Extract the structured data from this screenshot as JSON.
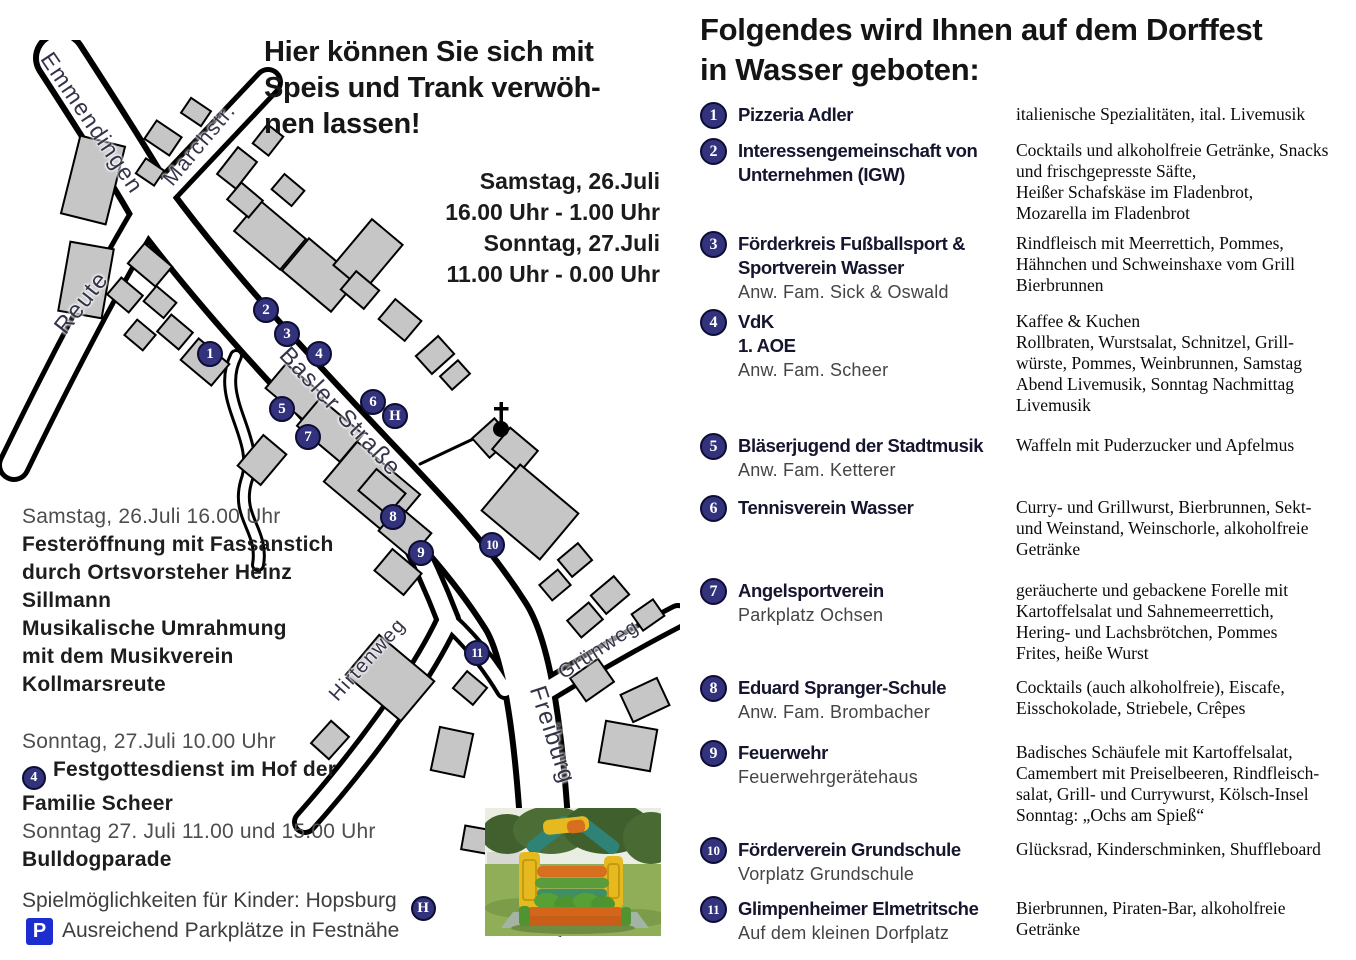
{
  "left": {
    "headline": "Hier können Sie sich mit\nSpeis und Trank verwöh-\nnen lassen!",
    "schedule": "Samstag, 26.Juli\n16.00 Uhr - 1.00 Uhr\nSonntag, 27.Juli\n11.00 Uhr - 0.00 Uhr",
    "saturday": {
      "time": "Samstag, 26.Juli 16.00 Uhr",
      "event1": "Festeröffnung mit Fassanstich\ndurch Ortsvorsteher Heinz\nSillmann",
      "event2": "Musikalische Umrahmung\nmit dem Musikverein\nKollmarsreute"
    },
    "sunday": {
      "time": "Sonntag, 27.Juli 10.00 Uhr",
      "badge": "4",
      "event1": "Festgottesdienst im Hof der",
      "event1b": "Familie Scheer",
      "time2": "Sonntag 27. Juli 11.00 und 15.00 Uhr",
      "event2": "Bulldogparade"
    },
    "kids_line": "Spielmöglichkeiten für Kinder: Hopsburg",
    "kids_badge": "H",
    "parking_icon": "P",
    "parking_line": "Ausreichend Parkplätze in Festnähe"
  },
  "map": {
    "streets": [
      {
        "label": "Emmendingen",
        "x": 92,
        "y": 83,
        "rot": 56,
        "size": 23
      },
      {
        "label": "Marchstr.",
        "x": 200,
        "y": 105,
        "rot": -50,
        "size": 21
      },
      {
        "label": "Reute",
        "x": 82,
        "y": 263,
        "rot": -52,
        "size": 24
      },
      {
        "label": "Basler Straße",
        "x": 340,
        "y": 372,
        "rot": 47,
        "size": 24
      },
      {
        "label": "Hirtenweg",
        "x": 368,
        "y": 620,
        "rot": -48,
        "size": 20
      },
      {
        "label": "Grünweg",
        "x": 599,
        "y": 610,
        "rot": -33,
        "size": 20
      },
      {
        "label": "Freiburg",
        "x": 552,
        "y": 695,
        "rot": 72,
        "size": 24
      }
    ],
    "markers": [
      {
        "label": "1",
        "x": 210,
        "y": 314
      },
      {
        "label": "2",
        "x": 266,
        "y": 270
      },
      {
        "label": "3",
        "x": 287,
        "y": 294
      },
      {
        "label": "4",
        "x": 319,
        "y": 314
      },
      {
        "label": "5",
        "x": 282,
        "y": 369
      },
      {
        "label": "6",
        "x": 373,
        "y": 362
      },
      {
        "label": "H",
        "x": 395,
        "y": 376
      },
      {
        "label": "7",
        "x": 308,
        "y": 397
      },
      {
        "label": "8",
        "x": 393,
        "y": 477
      },
      {
        "label": "9",
        "x": 421,
        "y": 513
      },
      {
        "label": "10",
        "x": 492,
        "y": 505
      },
      {
        "label": "11",
        "x": 477,
        "y": 613
      }
    ]
  },
  "right": {
    "heading": "Folgendes wird Ihnen auf dem Dorffest\nin Wasser geboten:",
    "items": [
      {
        "num": "1",
        "name": "Pizzeria Adler",
        "sub": "",
        "desc": "italienische Spezialitäten, ital. Livemusik"
      },
      {
        "num": "2",
        "name": "Interessengemeinschaft von\nUnternehmen (IGW)",
        "sub": "",
        "desc": "Cocktails und alkoholfreie Getränke, Snacks\nund frischgepresste Säfte,\nHeißer Schafskäse im Fladenbrot,\nMozarella im Fladenbrot"
      },
      {
        "num": "3",
        "name": "Förderkreis Fußballsport &\nSportverein Wasser",
        "sub": "Anw. Fam. Sick & Oswald",
        "desc": "Rindfleisch mit Meerrettich, Pommes,\nHähnchen und Schweinshaxe vom Grill\nBierbrunnen"
      },
      {
        "num": "4",
        "name": "VdK\n1. AOE",
        "sub": "Anw. Fam. Scheer",
        "desc": "Kaffee & Kuchen\nRollbraten, Wurstsalat, Schnitzel, Grill-\nwürste, Pommes, Weinbrunnen, Samstag\nAbend Livemusik, Sonntag Nachmittag\nLivemusik"
      },
      {
        "num": "5",
        "name": "Bläserjugend der Stadtmusik",
        "sub": "Anw. Fam. Ketterer",
        "desc": "Waffeln mit Puderzucker und Apfelmus"
      },
      {
        "num": "6",
        "name": "Tennisverein Wasser",
        "sub": "",
        "desc": "Curry- und Grillwurst, Bierbrunnen, Sekt-\nund Weinstand, Weinschorle, alkoholfreie\nGetränke"
      },
      {
        "num": "7",
        "name": "Angelsportverein",
        "sub": "Parkplatz Ochsen",
        "desc": "geräucherte und gebackene Forelle mit\nKartoffelsalat und Sahnemeerrettich,\nHering- und Lachsbrötchen, Pommes\nFrites, heiße Wurst"
      },
      {
        "num": "8",
        "name": "Eduard Spranger-Schule",
        "sub": "Anw. Fam. Brombacher",
        "desc": "Cocktails (auch alkoholfreie), Eiscafe,\nEisschokolade, Striebele, Crêpes"
      },
      {
        "num": "9",
        "name": "Feuerwehr",
        "sub": "Feuerwehrgerätehaus",
        "desc": "Badisches Schäufele mit Kartoffelsalat,\nCamembert mit Preiselbeeren, Rindfleisch-\nsalat, Grill- und Currywurst, Kölsch-Insel\nSonntag: „Ochs am Spieß“"
      },
      {
        "num": "10",
        "name": "Förderverein Grundschule",
        "sub": "Vorplatz Grundschule",
        "desc": "Glücksrad, Kinderschminken, Shuffleboard"
      },
      {
        "num": "11",
        "name": "Glimpenheimer Elmetritsche",
        "sub": "Auf dem kleinen Dorfplatz",
        "desc": "Bierbrunnen, Piraten-Bar, alkoholfreie\nGetränke"
      }
    ]
  },
  "colors": {
    "badge_navy": "#32327d",
    "badge_border": "#0d0d33",
    "parking_blue": "#1d2ed1",
    "building_gray": "#c6c6c6"
  }
}
